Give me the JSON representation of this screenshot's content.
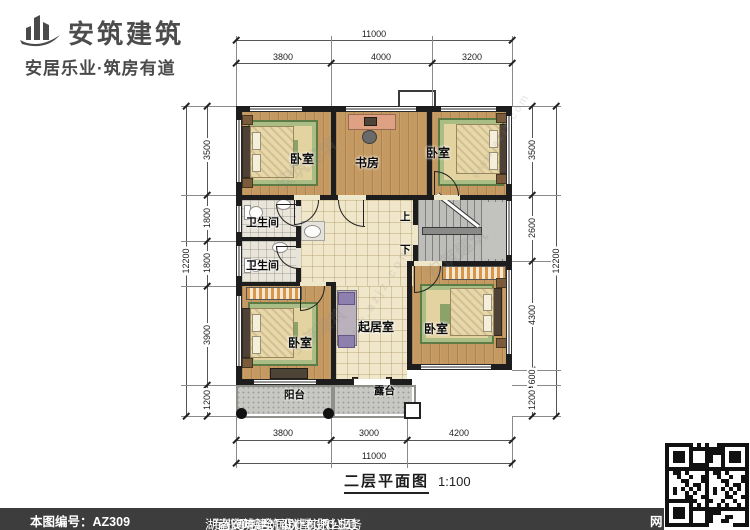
{
  "brand": {
    "name": "安筑建筑",
    "tagline": "安居乐业·筑房有道",
    "logo_icon": "building-swoosh-icon"
  },
  "plan": {
    "rooms": {
      "bedroom_tl": {
        "label": "卧室"
      },
      "study": {
        "label": "书房"
      },
      "bedroom_tr": {
        "label": "卧室"
      },
      "bath_1": {
        "label": "卫生间"
      },
      "bath_2": {
        "label": "卫生间"
      },
      "bedroom_bl": {
        "label": "卧室"
      },
      "living": {
        "label": "起居室"
      },
      "bedroom_br": {
        "label": "卧室"
      },
      "balcony": {
        "label": "阳台"
      },
      "terrace": {
        "label": "露台"
      }
    },
    "stairs": {
      "up": "上",
      "down": "下"
    }
  },
  "dims": {
    "top": {
      "overall": "11000",
      "segments": [
        "3800",
        "4000",
        "3200"
      ]
    },
    "bottom": {
      "overall": "11000",
      "segments": [
        "3800",
        "3000",
        "4200"
      ]
    },
    "left": {
      "overall": "12200",
      "segments": [
        "3500",
        "1800",
        "1800",
        "3900",
        "1200"
      ]
    },
    "right": {
      "overall": "12200",
      "segments": [
        "3500",
        "2600",
        "4300",
        "600",
        "1200"
      ]
    }
  },
  "title": {
    "text": "二层平面图",
    "scale": "1:100"
  },
  "footer": {
    "plan_no": "本图编号：AZ309",
    "company": "湖南安筑建筑设计有限公司",
    "service": "专业承接全国别墅设计业务",
    "phone": "咨询电话：400-8070-511",
    "qr_hint": "网"
  },
  "watermark": {
    "brand": "安筑建筑",
    "site": "www.azjz.com"
  },
  "colors": {
    "wall": "#1d1d1d",
    "wood_floor": "#c59a62",
    "tile_floor": "#f0e7ca",
    "stone": "#c7c7c3",
    "rug": "#8ba369",
    "footer_bg": "#3d3d3d",
    "brand_text": "#4c4c4c"
  }
}
